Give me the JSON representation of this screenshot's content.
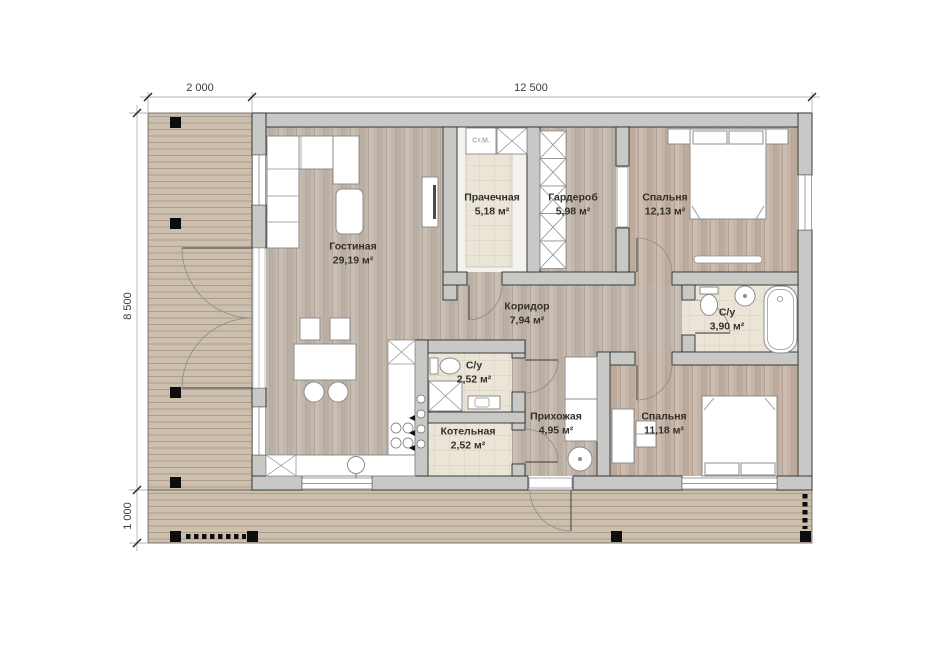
{
  "plan": {
    "dimensions": {
      "top_left": "2 000",
      "top_span": "12 500",
      "left_side": "8 500",
      "bottom_left": "1 000"
    },
    "rooms": [
      {
        "name": "Гостиная",
        "area": "29,19 м²"
      },
      {
        "name": "Прачечная",
        "area": "5,18 м²"
      },
      {
        "name": "Гардероб",
        "area": "5,98 м²"
      },
      {
        "name": "Спальня",
        "area": "12,13 м²"
      },
      {
        "name": "Коридор",
        "area": "7,94 м²"
      },
      {
        "name": "С/у",
        "area": "3,90 м²"
      },
      {
        "name": "С/у",
        "area": "2,52 м²"
      },
      {
        "name": "Котельная",
        "area": "2,52 м²"
      },
      {
        "name": "Прихожая",
        "area": "4,95 м²"
      },
      {
        "name": "Спальня",
        "area": "11,18 м²"
      }
    ],
    "appliances": {
      "washing_machine": "Ст.М."
    },
    "colors": {
      "wall": "#c8c8c6",
      "wood_floor": "#c2b7ac",
      "bedroom_floor": "#c4b5a8",
      "tile": "#ebe5d8",
      "deck": "#cdbfae"
    }
  }
}
